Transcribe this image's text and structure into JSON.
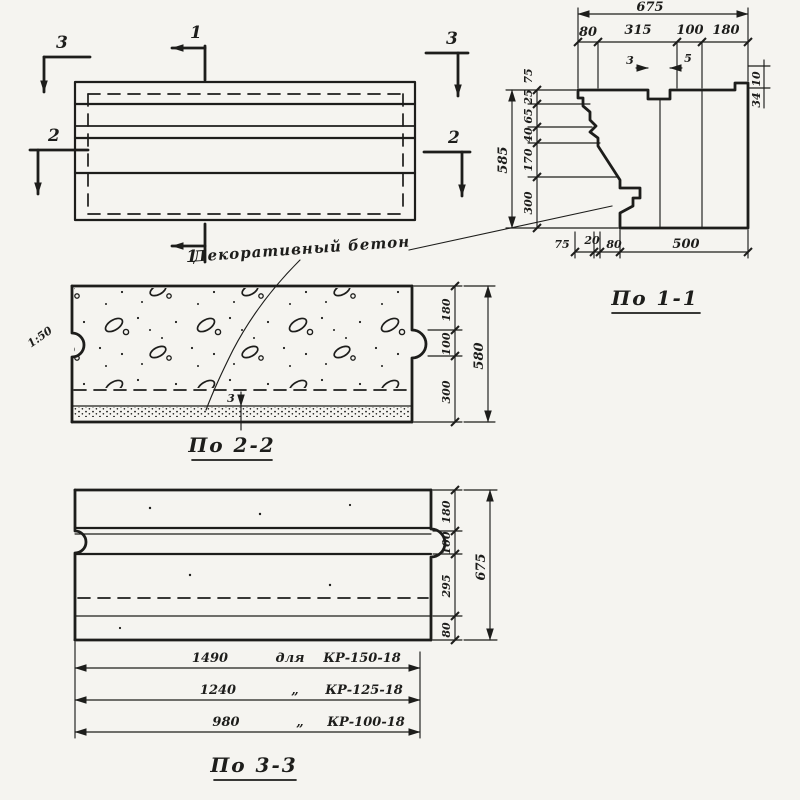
{
  "page": {
    "background": "#f5f4f0",
    "ink": "#1d1d1b"
  },
  "annotation": {
    "material_label": "Декоративный бетон"
  },
  "elevation": {
    "marks": {
      "m1": "1",
      "m2": "2",
      "m3": "3"
    }
  },
  "section11": {
    "title": "По 1-1",
    "overall_top": "675",
    "top_chain": [
      "80",
      "315",
      "100",
      "180"
    ],
    "notch_dims": [
      "3",
      "5"
    ],
    "right_small_dims": [
      "10",
      "34"
    ],
    "overall_left": "585",
    "left_chain_top_extra": "75",
    "left_chain": [
      "25",
      "65",
      "40",
      "170",
      "300"
    ],
    "bottom_chain": [
      "75",
      "20",
      "80",
      "500"
    ]
  },
  "section22": {
    "title": "По 2-2",
    "overall_right": "580",
    "right_chain": [
      "180",
      "100",
      "300"
    ],
    "slope": "1:50",
    "layer_thickness": "3"
  },
  "section33": {
    "title": "По 3-3",
    "overall_right": "675",
    "right_chain": [
      "180",
      "100",
      "295",
      "80"
    ],
    "length_table": [
      {
        "length": "1490",
        "word": "для",
        "mark": "КР-150-18"
      },
      {
        "length": "1240",
        "word": "„",
        "mark": "КР-125-18"
      },
      {
        "length": "980",
        "word": "„",
        "mark": "КР-100-18"
      }
    ]
  }
}
